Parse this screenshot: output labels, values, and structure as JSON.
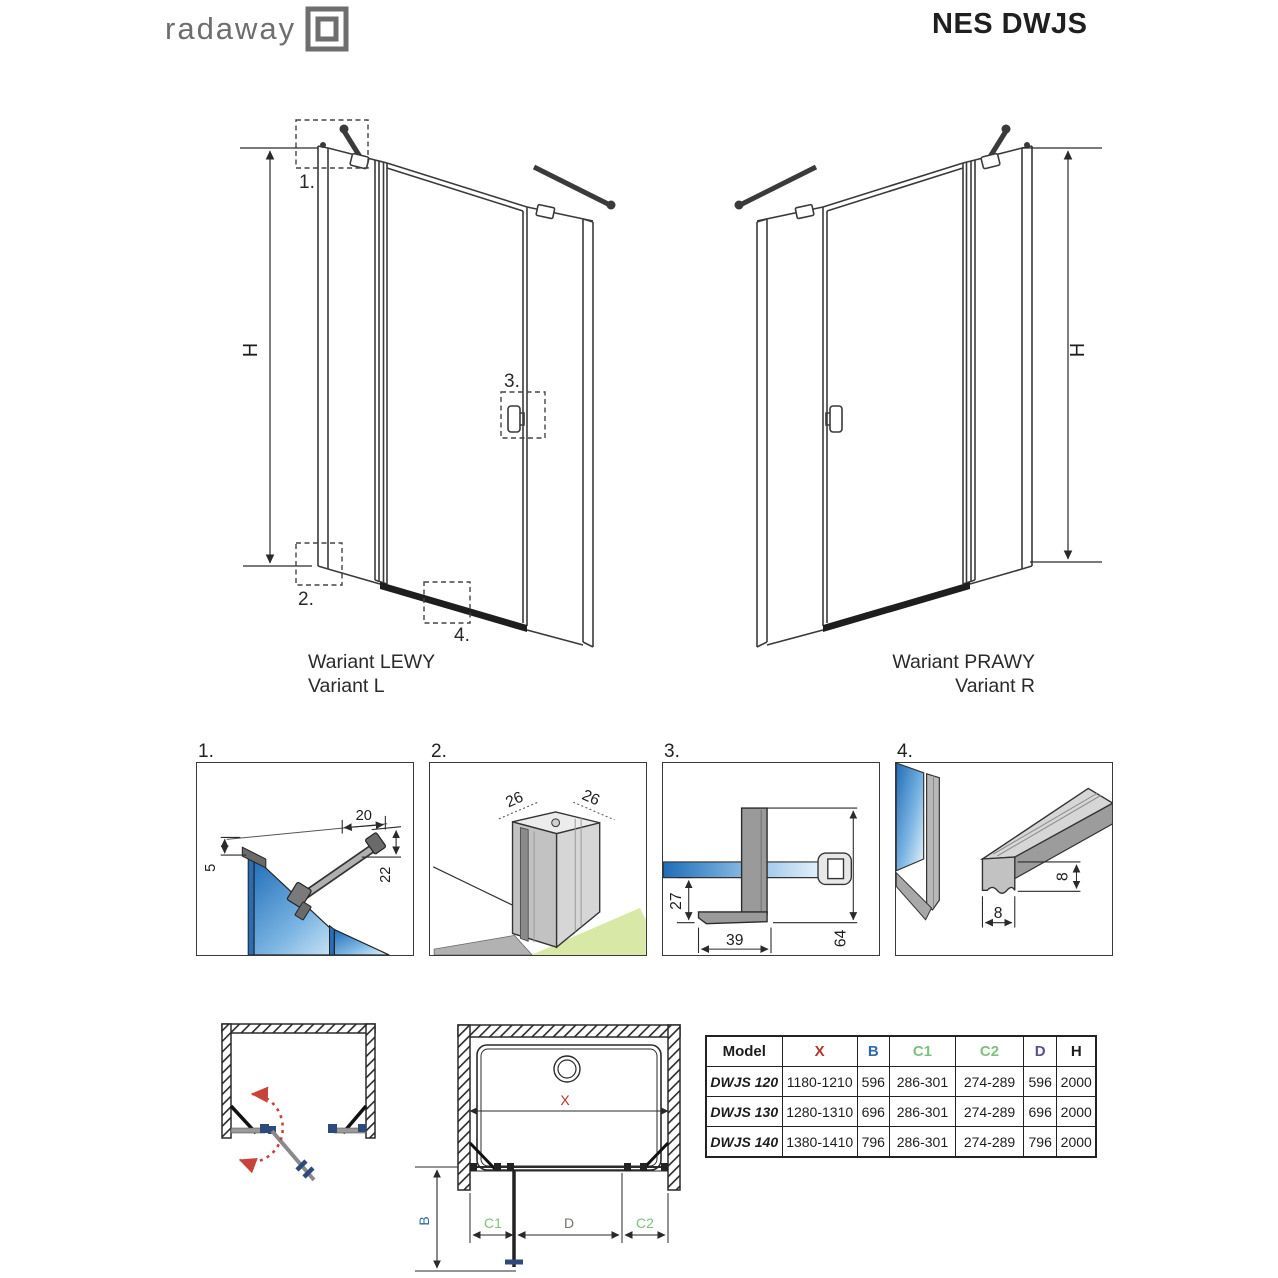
{
  "header": {
    "logo": "radaway",
    "title": "NES DWJS"
  },
  "variant_left": {
    "caption_pl": "Wariant LEWY",
    "caption_en": "Variant L",
    "height_label": "H",
    "callout_1": "1.",
    "callout_2": "2.",
    "callout_3": "3.",
    "callout_4": "4."
  },
  "variant_right": {
    "caption_pl": "Wariant PRAWY",
    "caption_en": "Variant R",
    "height_label": "H"
  },
  "details": {
    "d1": {
      "label": "1.",
      "dim_width": "20",
      "dim_left": "5",
      "dim_right": "22"
    },
    "d2": {
      "label": "2.",
      "dim_left": "26",
      "dim_right": "26"
    },
    "d3": {
      "label": "3.",
      "dim_drop": "27",
      "dim_foot": "39",
      "dim_height": "64"
    },
    "d4": {
      "label": "4.",
      "dim_width": "8",
      "dim_height": "8"
    }
  },
  "plan": {
    "x": "X",
    "b": "B",
    "c1": "C1",
    "d": "D",
    "c2": "C2"
  },
  "colors": {
    "x": "#b5342c",
    "b": "#2e6da4",
    "c1": "#7ec07e",
    "c2": "#7ec07e",
    "d_table": "#5c4e8e",
    "d_plan": "#6e766e",
    "arc_red": "#c8443a"
  },
  "table": {
    "col_model": "Model",
    "col_x": "X",
    "col_b": "B",
    "col_c1": "C1",
    "col_c2": "C2",
    "col_d": "D",
    "col_h": "H",
    "rows": [
      {
        "model": "DWJS 120",
        "x": "1180-1210",
        "b": "596",
        "c1": "286-301",
        "c2": "274-289",
        "d": "596",
        "h": "2000"
      },
      {
        "model": "DWJS 130",
        "x": "1280-1310",
        "b": "696",
        "c1": "286-301",
        "c2": "274-289",
        "d": "696",
        "h": "2000"
      },
      {
        "model": "DWJS 140",
        "x": "1380-1410",
        "b": "796",
        "c1": "286-301",
        "c2": "274-289",
        "d": "796",
        "h": "2000"
      }
    ]
  }
}
